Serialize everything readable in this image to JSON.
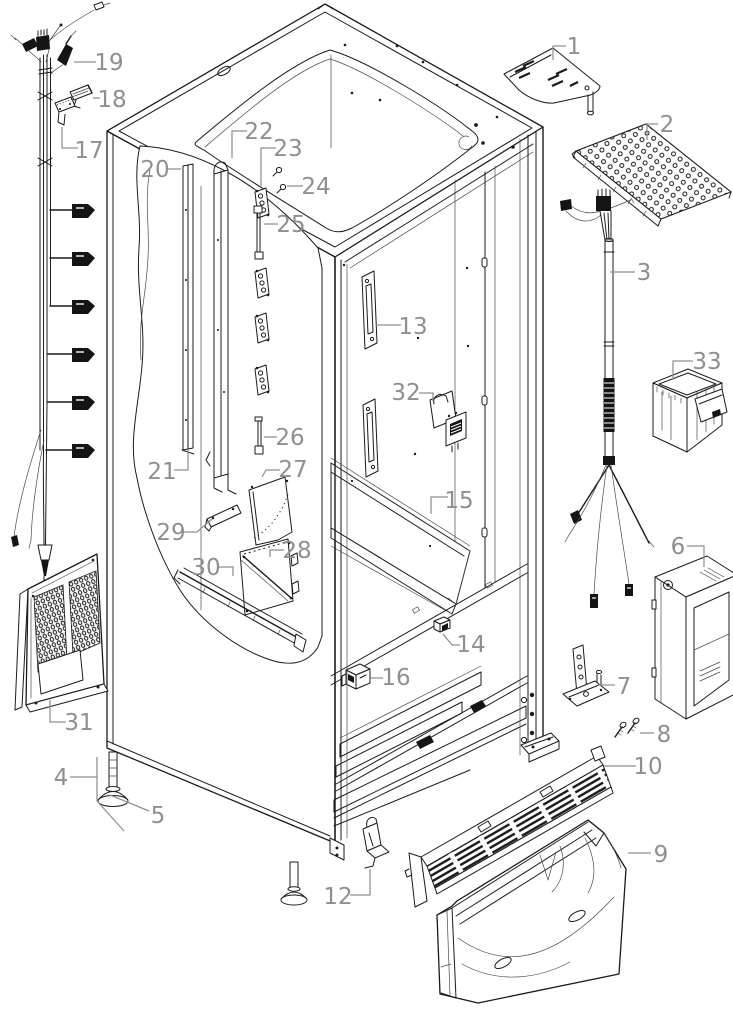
{
  "figure": {
    "type": "exploded-parts-diagram",
    "subject": "refrigerator cabinet exploded view",
    "background": "#ffffff",
    "line_color": "#1b1b1b",
    "label_color": "#8f8f8f",
    "leader_width": 1.25,
    "label_font_size": 23,
    "callouts": [
      {
        "number": "1",
        "x": 574,
        "y": 54,
        "segs": [
          "566,46 553,46 553,60"
        ]
      },
      {
        "number": "2",
        "x": 667,
        "y": 132,
        "segs": [
          "658,124 647,124 647,140"
        ]
      },
      {
        "number": "3",
        "x": 644,
        "y": 280,
        "segs": [
          "635,272 610,272"
        ]
      },
      {
        "number": "4",
        "x": 61,
        "y": 785,
        "segs": [
          "70,777 97,777",
          "97,757 97,801",
          "97,801 124,831"
        ]
      },
      {
        "number": "5",
        "x": 158,
        "y": 823,
        "segs": [
          "149,811 110,795"
        ]
      },
      {
        "number": "6",
        "x": 678,
        "y": 554,
        "segs": [
          "687,546 704,546 704,567"
        ]
      },
      {
        "number": "7",
        "x": 624,
        "y": 694,
        "segs": [
          "615,685 598,685"
        ]
      },
      {
        "number": "8",
        "x": 664,
        "y": 742,
        "segs": [
          "654,733 640,733"
        ]
      },
      {
        "number": "9",
        "x": 661,
        "y": 862,
        "segs": [
          "651,853 628,853"
        ]
      },
      {
        "number": "10",
        "x": 648,
        "y": 774,
        "segs": [
          "636,766 604,766"
        ]
      },
      {
        "number": "12",
        "x": 338,
        "y": 904,
        "segs": [
          "350,895 370,895 370,869"
        ]
      },
      {
        "number": "13",
        "x": 413,
        "y": 334,
        "segs": [
          "401,325 376,325"
        ]
      },
      {
        "number": "14",
        "x": 471,
        "y": 652,
        "segs": [
          "460,645 452,645 443,634"
        ]
      },
      {
        "number": "15",
        "x": 459,
        "y": 508,
        "segs": [
          "448,497 431,497 431,514"
        ]
      },
      {
        "number": "16",
        "x": 396,
        "y": 685,
        "segs": [
          "383,678 371,678"
        ]
      },
      {
        "number": "17",
        "x": 89,
        "y": 158,
        "segs": [
          "78,148 62,148 62,127"
        ]
      },
      {
        "number": "18",
        "x": 112,
        "y": 107,
        "segs": [
          "100,98 93,98"
        ]
      },
      {
        "number": "19",
        "x": 109,
        "y": 70,
        "segs": [
          "96,62 74,62"
        ]
      },
      {
        "number": "20",
        "x": 155,
        "y": 177,
        "segs": [
          "167,169 181,169"
        ]
      },
      {
        "number": "21",
        "x": 162,
        "y": 479,
        "segs": [
          "174,470 188,470 188,450"
        ]
      },
      {
        "number": "22",
        "x": 259,
        "y": 139,
        "segs": [
          "247,131 232,131 232,158"
        ]
      },
      {
        "number": "23",
        "x": 288,
        "y": 156,
        "segs": [
          "276,148 261,148 261,186"
        ]
      },
      {
        "number": "24",
        "x": 316,
        "y": 194,
        "segs": [
          "303,186 287,186"
        ]
      },
      {
        "number": "25",
        "x": 291,
        "y": 232,
        "segs": [
          "278,224 264,224"
        ]
      },
      {
        "number": "26",
        "x": 290,
        "y": 445,
        "segs": [
          "277,437 264,437"
        ]
      },
      {
        "number": "27",
        "x": 293,
        "y": 477,
        "segs": [
          "280,470 266,470 262,477"
        ]
      },
      {
        "number": "28",
        "x": 297,
        "y": 558,
        "segs": [
          "284,550 270,550 270,557"
        ]
      },
      {
        "number": "29",
        "x": 171,
        "y": 540,
        "segs": [
          "183,532 197,532 212,519"
        ]
      },
      {
        "number": "30",
        "x": 206,
        "y": 575,
        "segs": [
          "219,567 233,567 233,576"
        ]
      },
      {
        "number": "31",
        "x": 79,
        "y": 730,
        "segs": [
          "66,722 50,722 50,700"
        ]
      },
      {
        "number": "32",
        "x": 406,
        "y": 400,
        "segs": [
          "419,393 433,393 433,401"
        ]
      },
      {
        "number": "33",
        "x": 707,
        "y": 369,
        "segs": [
          "693,361 673,361 673,380"
        ]
      }
    ]
  }
}
